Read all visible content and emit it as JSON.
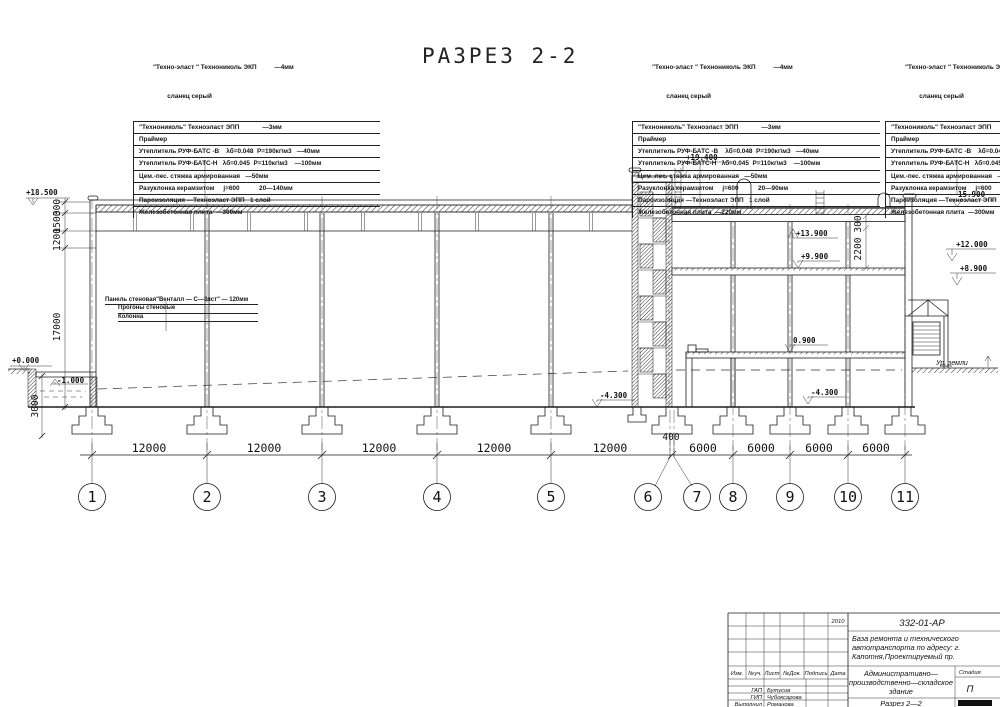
{
  "title": "РАЗРЕЗ 2-2",
  "specs": {
    "left": {
      "h1": "\"Техно-эласт \" Технониколь ЭКП          —4мм",
      "h2": "        сланец серый",
      "rows": [
        "\"Технониколь\" Техноэласт ЭПП             —3мм",
        "Праймер",
        "Утеплитель РУФ-БАТС -В    λб=0.048  Р=190кг\\м3   —40мм",
        "Утеплитель РУФ-БАТС-Н   λб=0.045  Р=110кг\\м3    —100мм",
        "Цем.-пес. стяжка армированная   —50мм",
        "Разуклонка керамзитом     j=600           20—140мм",
        "Пароизоляция —Техноэласт ЭПП   1 слой",
        "Железобетонная плита  —300мм"
      ]
    },
    "mid": {
      "h1": "\"Техно-эласт \" Технониколь ЭКП          —4мм",
      "h2": "        сланец серый",
      "rows": [
        "\"Технониколь\" Техноэласт ЭПП             —3мм",
        "Праймер",
        "Утеплитель РУФ-БАТС -В    λб=0.048  Р=190кг\\м3   —40мм",
        "Утеплитель РУФ-БАТС-Н   λб=0.045  Р=110кг\\м3    —100мм",
        "Цем.-пес. стяжка армированная   —50мм",
        "Разуклонка керамзитом     j=600           20—90мм",
        "Пароизоляция —Техноэласт ЭПП   1 слой",
        "Железобетонная плита  —220мм"
      ]
    },
    "right": {
      "h1": "\"Техно-эласт \" Технониколь ЭКП          —4мм",
      "h2": "        сланец серый",
      "rows": [
        "\"Технониколь\" Техноэласт ЭПП             —3мм",
        "Праймер",
        "Утеплитель РУФ-БАТС -В    λб=0.048  Р=190кг\\м3   —40мм",
        "Утеплитель РУФ-БАТС-Н   λб=0.045  Р=110кг\\м3    —100мм",
        "Цем.-пес. стяжка армированная   —50мм",
        "Разуклонка керамзитом     j=600           20—140мм",
        "Пароизоляция —Техноэласт ЭПП   1 слой",
        "Железобетонная плита  —300мм"
      ]
    }
  },
  "wall_callout": {
    "l1": "Панель стеновая\"Венталл — С—3пст\" — 120мм",
    "l2": "Прогоны стеновые",
    "l3": "Колонна"
  },
  "levels": {
    "p185": "+18.500",
    "p194": "+19.400",
    "p139": "+13.900",
    "p99": "+9.900",
    "p09": "0.900",
    "m43a": "-4.300",
    "m43b": "-4.300",
    "p00": "+0.000",
    "m10": "-1.000",
    "p159": "15.900",
    "p120": "+12.000",
    "p89": "+8.900",
    "ground": "Ур. земли"
  },
  "dims": {
    "d12000": "12000",
    "d6000": "6000",
    "d400": "400",
    "d300": "300",
    "d1500": "1500",
    "d1200": "1200",
    "d17000": "17000",
    "d3000": "3000",
    "d300b": "300",
    "d2200": "2200"
  },
  "axes": [
    "1",
    "2",
    "3",
    "4",
    "5",
    "6",
    "7",
    "8",
    "9",
    "10",
    "11"
  ],
  "titleblock": {
    "year": "2010",
    "doc": "332-01-АР",
    "desc1": "База ремонта и технического",
    "desc2": "автотранспорта по адресу: г.",
    "desc3": "Капотня,Проектируемый пр. ",
    "cols": [
      "Изм.",
      "№уч.",
      "Лист",
      "№Док.",
      "Подпись",
      "Дата"
    ],
    "r1_role": "ГАП",
    "r1_name": "Бутусов",
    "r2_role": "ГИП",
    "r2_name": "Чубоксарова",
    "r3_role": "Выполнил",
    "r3_name": "Романова",
    "b1": "Административно—",
    "b2": "производственно—складское",
    "b3": "здание",
    "sheet": "Разрез 2—2",
    "stage_h": "Стадия",
    "stage": "П"
  }
}
